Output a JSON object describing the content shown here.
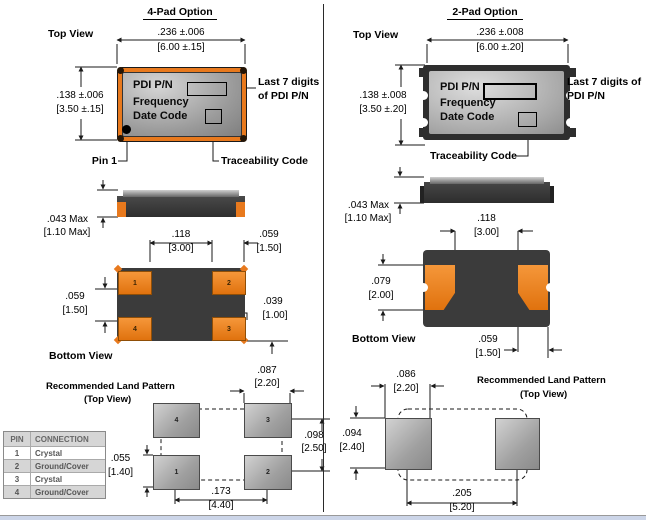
{
  "left": {
    "title": "4-Pad Option",
    "top_view_label": "Top View",
    "dim_width_in": ".236 ±.006",
    "dim_width_mm": "[6.00 ±.15]",
    "dim_height_in": ".138 ±.006",
    "dim_height_mm": "[3.50 ±.15]",
    "chip_lines": [
      "PDI P/N",
      "Frequency",
      "Date Code"
    ],
    "callout_line1": "Last 7 digits",
    "callout_line2": "of PDI P/N",
    "pin1_label": "Pin 1",
    "trace_label": "Traceability Code",
    "thick_in": ".043 Max",
    "thick_mm": "[1.10 Max]",
    "bottom_view_label": "Bottom View",
    "bv_span_in": ".118",
    "bv_span_mm": "[3.00]",
    "bv_padw_in": ".059",
    "bv_padw_mm": "[1.50]",
    "bv_padh_in": ".059",
    "bv_padh_mm": "[1.50]",
    "bv_edge_in": ".039",
    "bv_edge_mm": "[1.00]",
    "bv_pad_numbers": [
      "1",
      "2",
      "4",
      "3"
    ],
    "lp_title": "Recommended Land Pattern",
    "lp_sub": "(Top View)",
    "lp_padw_in": ".087",
    "lp_padw_mm": "[2.20]",
    "lp_rowpitch_in": ".098",
    "lp_rowpitch_mm": "[2.50]",
    "lp_padh_in": ".055",
    "lp_padh_mm": "[1.40]",
    "lp_colpitch_in": ".173",
    "lp_colpitch_mm": "[4.40]",
    "lp_pad_numbers": [
      "4",
      "3",
      "1",
      "2"
    ]
  },
  "right": {
    "title": "2-Pad Option",
    "top_view_label": "Top View",
    "dim_width_in": ".236 ±.008",
    "dim_width_mm": "[6.00 ±.20]",
    "dim_height_in": ".138 ±.008",
    "dim_height_mm": "[3.50 ±.20]",
    "chip_lines": [
      "PDI P/N",
      "Frequency",
      "Date Code"
    ],
    "callout_line1": "Last 7 digits of",
    "callout_line2": "PDI P/N",
    "trace_label": "Traceability Code",
    "thick_in": ".043 Max",
    "thick_mm": "[1.10 Max]",
    "bottom_view_label": "Bottom View",
    "bv_span_in": ".118",
    "bv_span_mm": "[3.00]",
    "bv_padh_in": ".079",
    "bv_padh_mm": "[2.00]",
    "bv_padw_in": ".059",
    "bv_padw_mm": "[1.50]",
    "lp_title": "Recommended Land Pattern",
    "lp_sub": "(Top View)",
    "lp_padw_in": ".086",
    "lp_padw_mm": "[2.20]",
    "lp_padh_in": ".094",
    "lp_padh_mm": "[2.40]",
    "lp_pitch_in": ".205",
    "lp_pitch_mm": "[5.20]"
  },
  "pin_table": {
    "headers": [
      "PIN",
      "CONNECTION"
    ],
    "rows": [
      [
        "1",
        "Crystal"
      ],
      [
        "2",
        "Ground/Cover"
      ],
      [
        "3",
        "Crystal"
      ],
      [
        "4",
        "Ground/Cover"
      ]
    ]
  },
  "colors": {
    "pad_orange": "#e8791d",
    "body_dark": "#3b3b3b",
    "footer_bar": "#ccd5e8"
  }
}
